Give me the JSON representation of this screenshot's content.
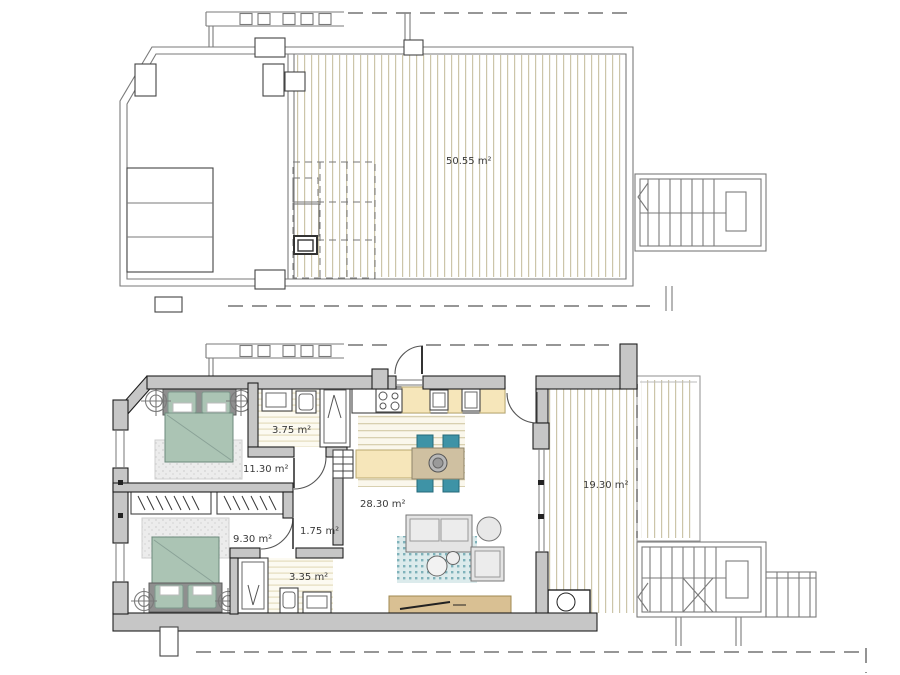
{
  "document": {
    "type": "architectural-floor-plan",
    "background": "#ffffff"
  },
  "labels": {
    "upper_terrace": "50.55 m²",
    "bedroom1": "11.30 m²",
    "bathroom1": "3.75 m²",
    "living_kitchen": "28.30 m²",
    "hall": "1.75 m²",
    "bedroom2": "9.30 m²",
    "bathroom2": "3.35 m²",
    "terrace": "19.30 m²"
  },
  "colors": {
    "wall_fill": "#c6c6c6",
    "wall_edge": "#1f1f1f",
    "thin_line": "#7a7a7a",
    "deck_stripe": "#ccc5a9",
    "floor_stripe": "#e4dcbd",
    "bed_green": "#abc4b4",
    "headboard_gray": "#8f8f8f",
    "chair_teal": "#3e93a6",
    "rug_teal_dot": "#7fb2ba",
    "counter_yellow": "#f6e6ba",
    "table_tan": "#cfc0a1",
    "sideboard_tan": "#d9c093",
    "label_text": "#3a3a3a"
  }
}
